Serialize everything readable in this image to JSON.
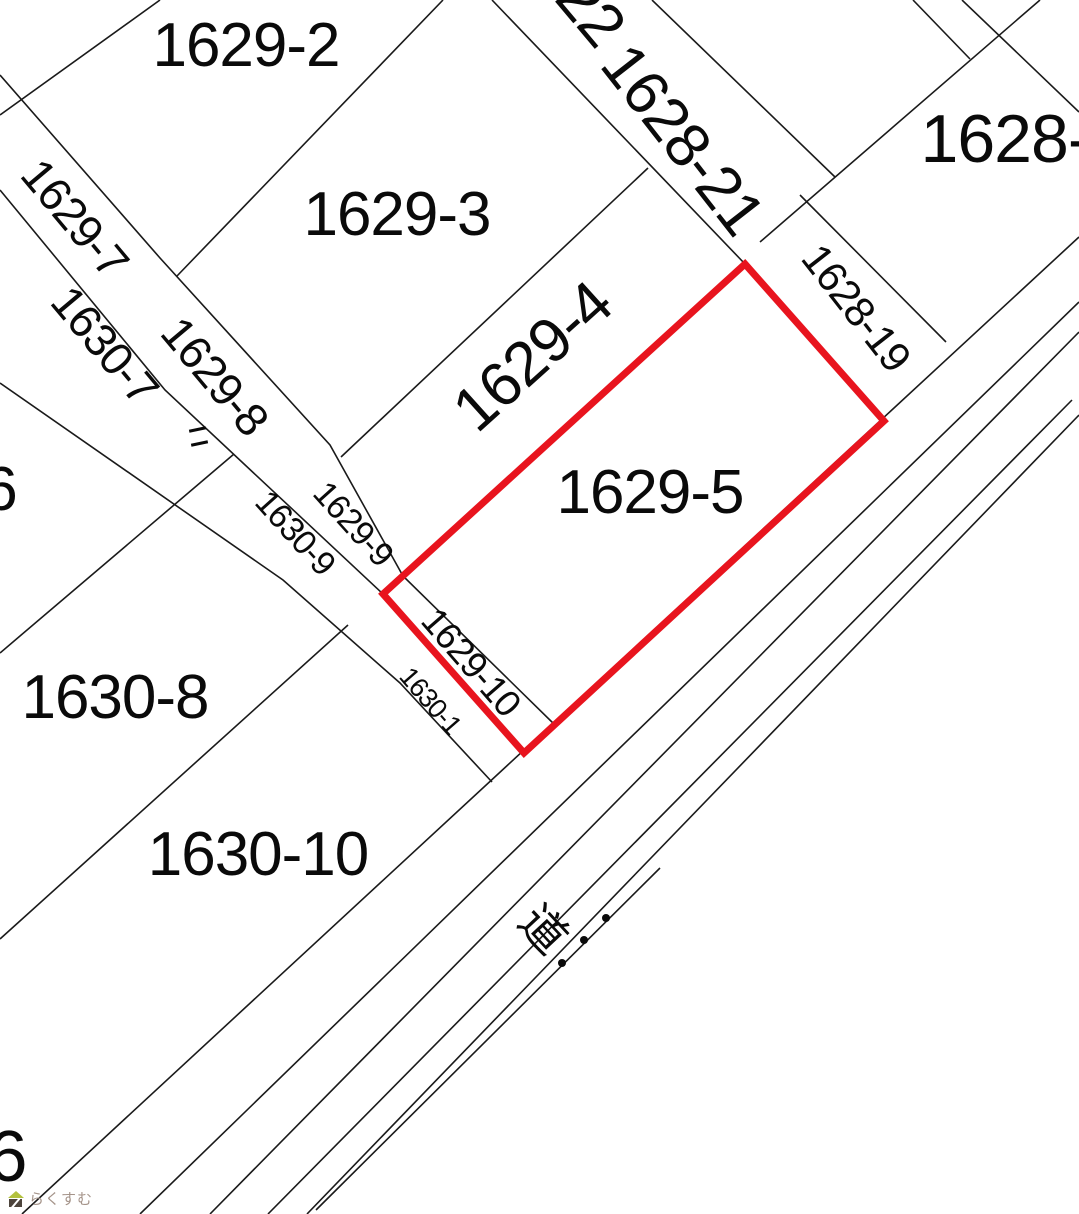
{
  "parcel_labels": {
    "p1629_2": "1629-2",
    "p1629_3": "1629-3",
    "p1629_4": "1629-4",
    "p1629_5": "1629-5",
    "p1629_7": "1629-7",
    "p1629_8": "1629-8",
    "p1629_9": "1629-9",
    "p1629_10": "1629-10",
    "p1628_partial": "1628-",
    "p1628_21": "1628-21",
    "p1628_22_partial": "22",
    "p1628_19": "1628-19",
    "p1630_1": "1630-1",
    "p1630_7": "1630-7",
    "p1630_8": "1630-8",
    "p1630_9": "1630-9",
    "p1630_10": "1630-10",
    "p_left_edge_partial": "6",
    "p_bottom_edge_partial": "6"
  },
  "road": {
    "label": "道"
  },
  "highlight": {
    "parcel_number": "1629-5",
    "color": "#e8141e"
  },
  "watermark": {
    "text": "らくすむ"
  }
}
